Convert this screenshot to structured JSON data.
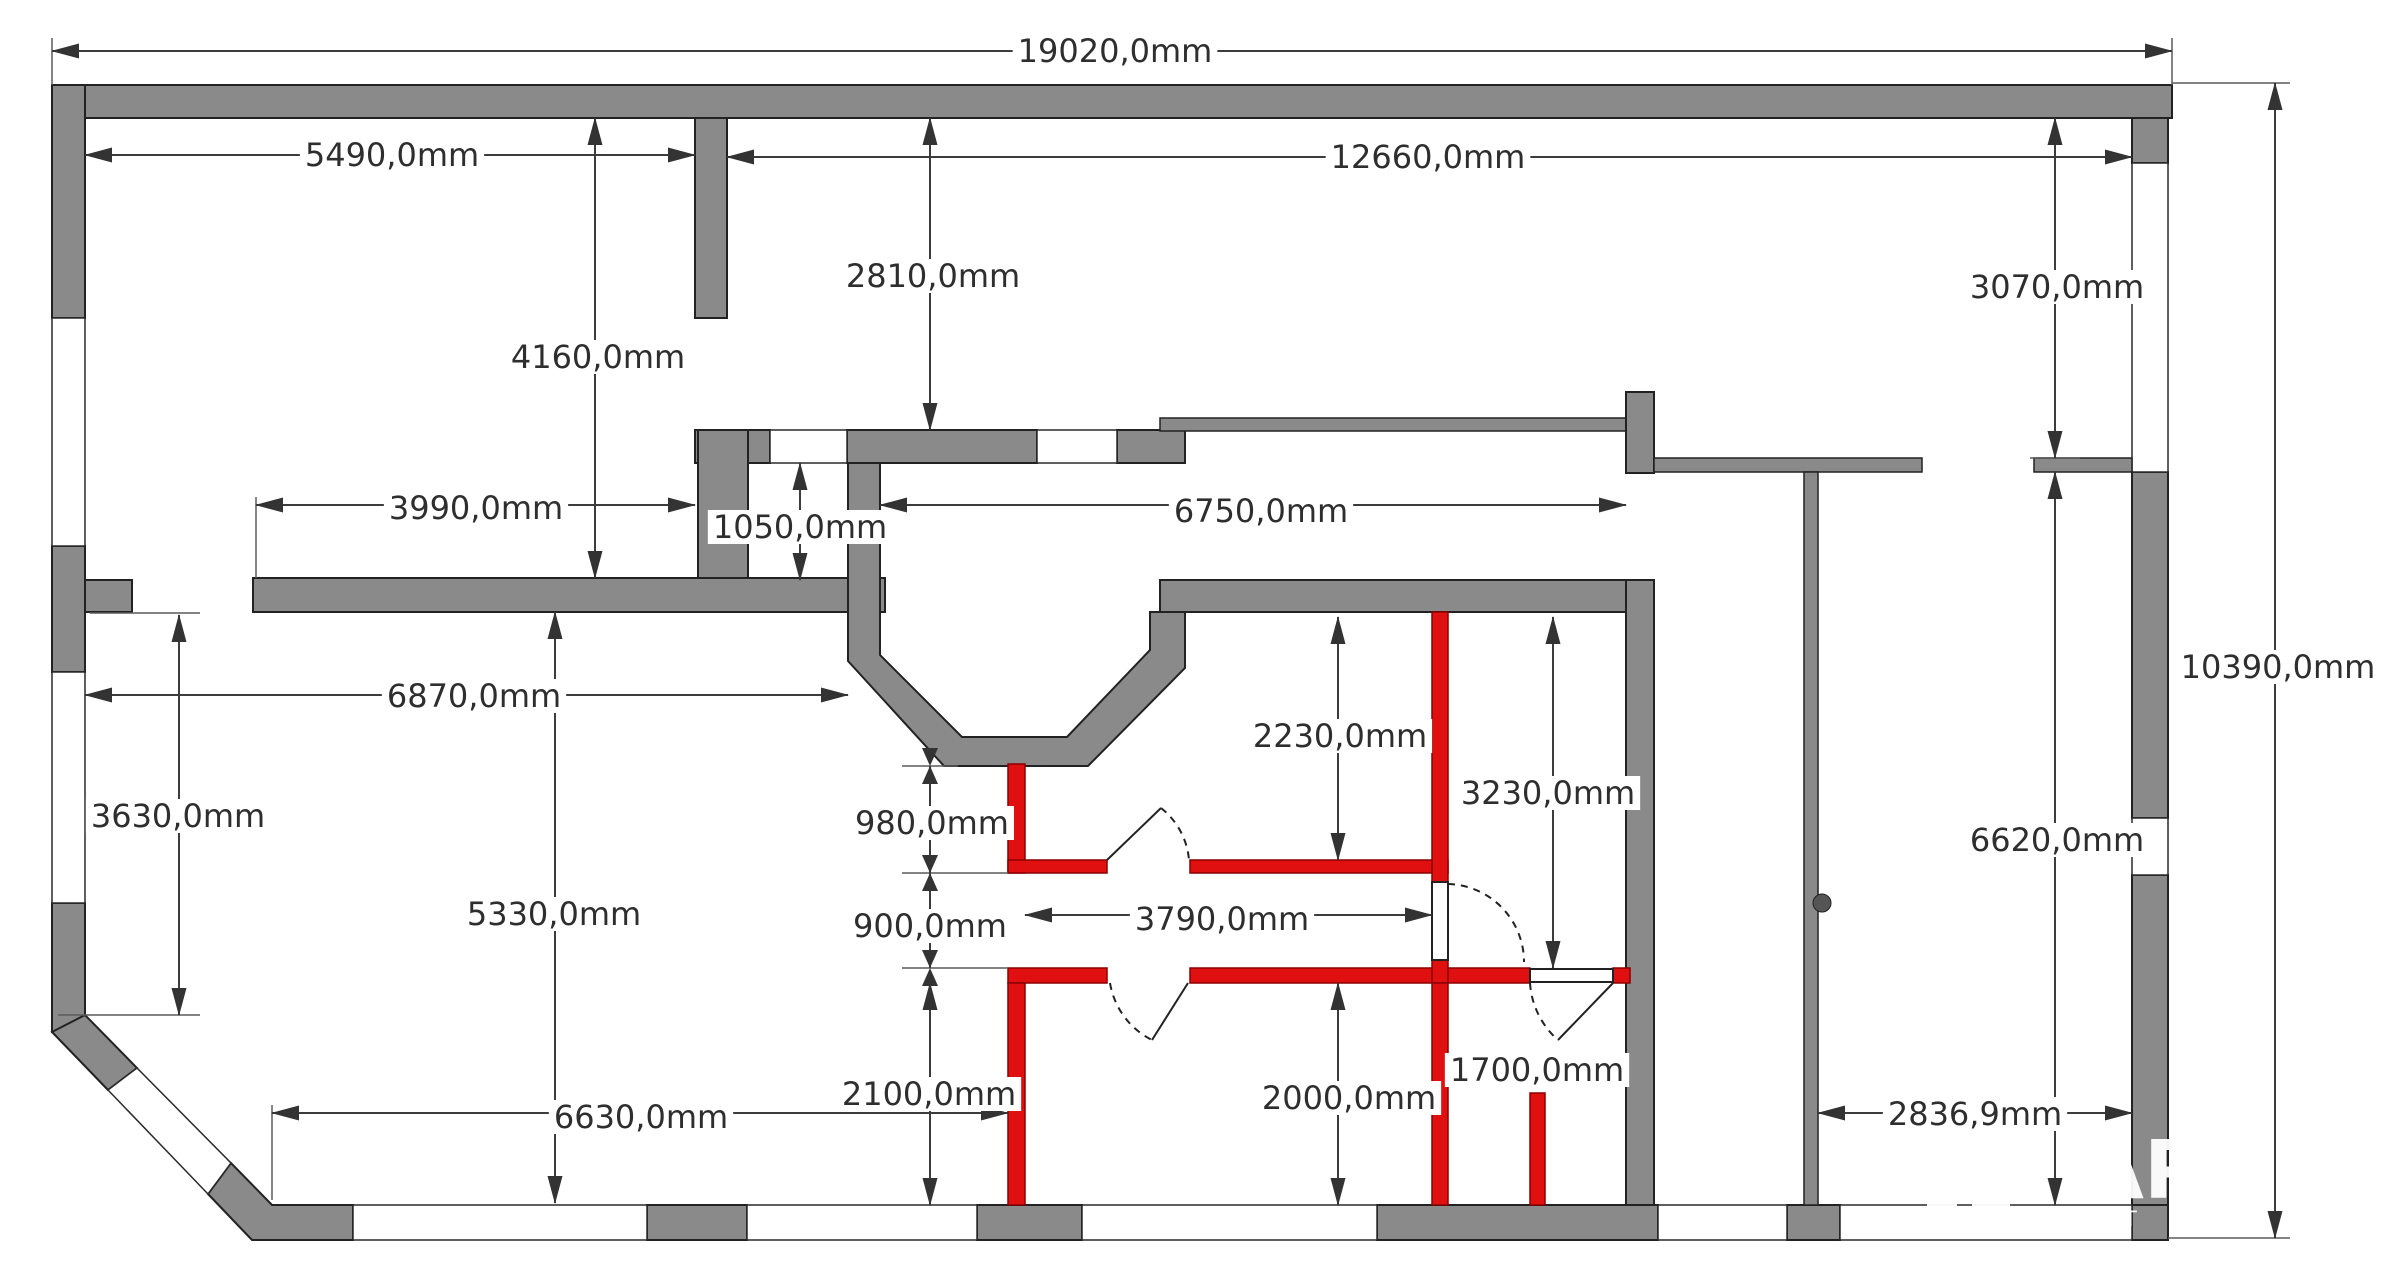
{
  "floorplan": {
    "title": "apartment-floor-plan",
    "units": "mm",
    "colors": {
      "wall": "#8a8a8a",
      "new_wall": "#e01010",
      "dimension": "#3c3c3c",
      "background": "#ffffff"
    },
    "overall": {
      "width_label": "19020,0mm",
      "height_label": "10390,0mm"
    },
    "dimensions": [
      {
        "id": "19020",
        "text": "19020,0mm",
        "x": 1115,
        "y": 51
      },
      {
        "id": "5490",
        "text": "5490,0mm",
        "x": 392,
        "y": 155
      },
      {
        "id": "12660",
        "text": "12660,0mm",
        "x": 1428,
        "y": 157
      },
      {
        "id": "2810",
        "text": "2810,0mm",
        "x": 933,
        "y": 276
      },
      {
        "id": "4160",
        "text": "4160,0mm",
        "x": 598,
        "y": 357
      },
      {
        "id": "3070",
        "text": "3070,0mm",
        "x": 2057,
        "y": 287
      },
      {
        "id": "3990",
        "text": "3990,0mm",
        "x": 476,
        "y": 508
      },
      {
        "id": "1050",
        "text": "1050,0mm",
        "x": 800,
        "y": 527
      },
      {
        "id": "6750",
        "text": "6750,0mm",
        "x": 1261,
        "y": 511
      },
      {
        "id": "10390",
        "text": "10390,0mm",
        "x": 2278,
        "y": 667
      },
      {
        "id": "6870",
        "text": "6870,0mm",
        "x": 474,
        "y": 696
      },
      {
        "id": "3630",
        "text": "3630,0mm",
        "x": 178,
        "y": 816
      },
      {
        "id": "2230",
        "text": "2230,0mm",
        "x": 1340,
        "y": 736
      },
      {
        "id": "3230",
        "text": "3230,0mm",
        "x": 1548,
        "y": 793
      },
      {
        "id": "6620",
        "text": "6620,0mm",
        "x": 2057,
        "y": 840
      },
      {
        "id": "980",
        "text": "980,0mm",
        "x": 932,
        "y": 823
      },
      {
        "id": "900",
        "text": "900,0mm",
        "x": 930,
        "y": 926
      },
      {
        "id": "3790",
        "text": "3790,0mm",
        "x": 1222,
        "y": 919
      },
      {
        "id": "5330",
        "text": "5330,0mm",
        "x": 554,
        "y": 914
      },
      {
        "id": "2100",
        "text": "2100,0mm",
        "x": 929,
        "y": 1094
      },
      {
        "id": "2000",
        "text": "2000,0mm",
        "x": 1349,
        "y": 1098
      },
      {
        "id": "1700",
        "text": "1700,0mm",
        "x": 1537,
        "y": 1070
      },
      {
        "id": "6630",
        "text": "6630,0mm",
        "x": 641,
        "y": 1117
      },
      {
        "id": "2836_9",
        "text": "2836,9mm",
        "x": 1975,
        "y": 1114
      }
    ],
    "watermark": {
      "big": "АР",
      "small": "Т L",
      "tiny": "о"
    }
  }
}
